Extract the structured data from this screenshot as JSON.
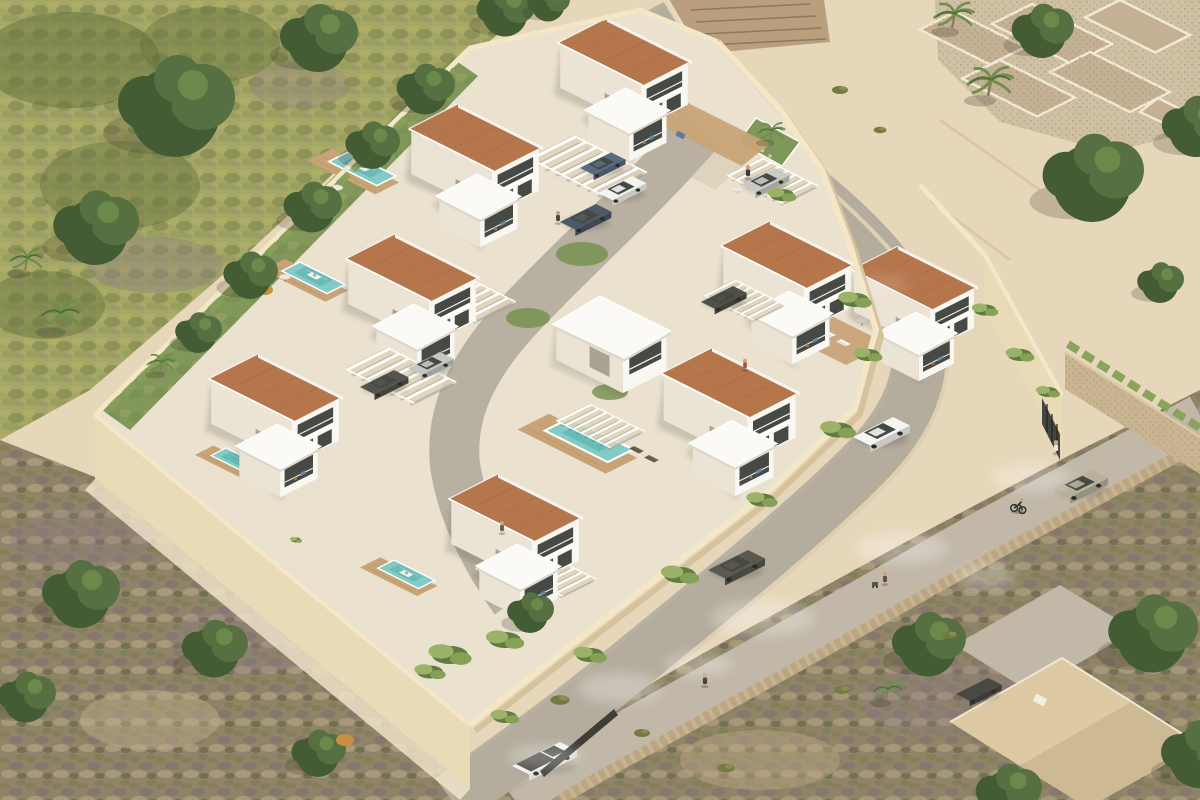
{
  "scene": {
    "type": "architectural-aerial-render",
    "setting": "Isometric aerial 3D visualisation of a gated hillside residential development of modern white villas with terracotta roofs, private pools and pergola carports, enclosed by beige rendered walls, with a curving access road, a dusty lower track, Mediterranean scrub, mature trees, stone ruin terraces and neighbouring houses.",
    "palette": {
      "sand": "#e7d7ba",
      "sandLight": "#f2e7cd",
      "moss": "#a4a765",
      "mossDark": "#5d6c3a",
      "purpleScrub": "#8d7b88",
      "scrub": "#8f8468",
      "scrubDark": "#6b6450",
      "paving": "#eae2cf",
      "drive": "#ded4bd",
      "wallTop": "#f3e7c8",
      "wallFace": "#e9dab8",
      "wallShade": "#d6c29c",
      "white": "#f8f7f2",
      "whiteShade": "#ebe3d3",
      "whiteRoof": "#fbfaf7",
      "slabShade": "#dcd8cc",
      "terracotta": "#b5764b",
      "terracottaDark": "#9a5e3a",
      "pool": "#84cbc6",
      "poolDeep": "#54aeab",
      "deck": "#c8a377",
      "deckShade": "#b28c60",
      "road": "#b8b0a1",
      "roadOld": "#c1b8a8",
      "stone": "#c9b491",
      "stoneDark": "#a08a6b",
      "ruinFloor": "#cfbfa3",
      "ruinCell": "#c4b093",
      "lawn": "#7b9454",
      "hedge": "#87a058",
      "vine": "#9ab368",
      "vineDark": "#5f7d40",
      "treeDark": "#435c34",
      "treeMid": "#567041",
      "treeLight": "#6f8d4c",
      "glass": "#474a44",
      "shadow": "#3a342a",
      "dust": "#ffffff",
      "skin": "#caa183"
    },
    "development": {
      "terracotta_roof_villas": 8,
      "white_cube_villas": 1,
      "pools": 5,
      "pergola_carports": 7,
      "perimeter": "beige rendered walls with trailing plants",
      "landscape_features": [
        "private gardens",
        "timber pool decks",
        "hedge rows along the north-west wall",
        "palms",
        "lawn bed with palm at the entrance corner"
      ]
    },
    "roads": {
      "access_road": "grey road curving around the north-east and south-east walls of the plot",
      "old_track": "dusty beige track below a rubble stone retaining wall",
      "inner_driveway": "light concrete driveway winding between the villa rows"
    },
    "surroundings": {
      "north_west": "dense green woodland over a mossy slope",
      "north": "neighbouring tiled roof behind the top wall",
      "north_east": "stone ruin terraces with palm trees on open sand",
      "south_west": "purple-brown Mediterranean scrub with scattered trees",
      "south_east": "neighbouring house with a sand-coloured hipped roof and grey driveway"
    },
    "vehicles": [
      {
        "id": "white-suv",
        "type": "suv",
        "color": "white",
        "location": "access road"
      },
      {
        "id": "dark-grey-suv",
        "type": "suv",
        "color": "dark grey",
        "location": "access road"
      },
      {
        "id": "beige-car",
        "type": "car",
        "color": "beige grey",
        "location": "old track"
      },
      {
        "id": "white-pickup",
        "type": "pickup truck",
        "color": "white",
        "location": "old track"
      },
      {
        "id": "neighbour-car",
        "type": "car",
        "color": "dark grey",
        "location": "neighbour driveway"
      },
      {
        "id": "carport-white-hatchback",
        "type": "hatchback",
        "color": "white",
        "location": "pergola carport"
      },
      {
        "id": "carport-blue-suv",
        "type": "suv",
        "color": "dark blue grey",
        "location": "pergola carport"
      },
      {
        "id": "carport-blue-estate",
        "type": "estate",
        "color": "steel blue",
        "location": "inner driveway"
      },
      {
        "id": "carport-silver-suv",
        "type": "suv",
        "color": "silver",
        "location": "pergola carport"
      },
      {
        "id": "carport-dark-saloon",
        "type": "saloon",
        "color": "dark grey",
        "location": "pergola carport"
      },
      {
        "id": "carport-grey-saloon",
        "type": "saloon",
        "color": "graphite",
        "location": "pergola carport"
      },
      {
        "id": "carport-silver-hatchback",
        "type": "hatchback",
        "color": "silver",
        "location": "pergola carport"
      }
    ],
    "people": [
      {
        "id": "walker-with-dog",
        "activity": "walking a small white dog near the entrance court"
      },
      {
        "id": "courtyard-walker-1",
        "activity": "walking on the inner driveway"
      },
      {
        "id": "courtyard-walker-2",
        "activity": "walking near the south gardens"
      },
      {
        "id": "balcony-resident",
        "activity": "standing on a villa balcony"
      },
      {
        "id": "pool-floater-1",
        "activity": "floating on a lilo in a pool"
      },
      {
        "id": "pool-floater-2",
        "activity": "floating in a second pool"
      },
      {
        "id": "pool-floater-3",
        "activity": "floating in the south pool"
      },
      {
        "id": "street-walker",
        "activity": "walking on the lower track"
      },
      {
        "id": "stroller-pusher",
        "activity": "pushing a stroller on the lower track"
      },
      {
        "id": "cyclist",
        "activity": "cycling on the lower track"
      },
      {
        "id": "gate-visitor",
        "activity": "standing at the outer wall gate"
      }
    ]
  }
}
